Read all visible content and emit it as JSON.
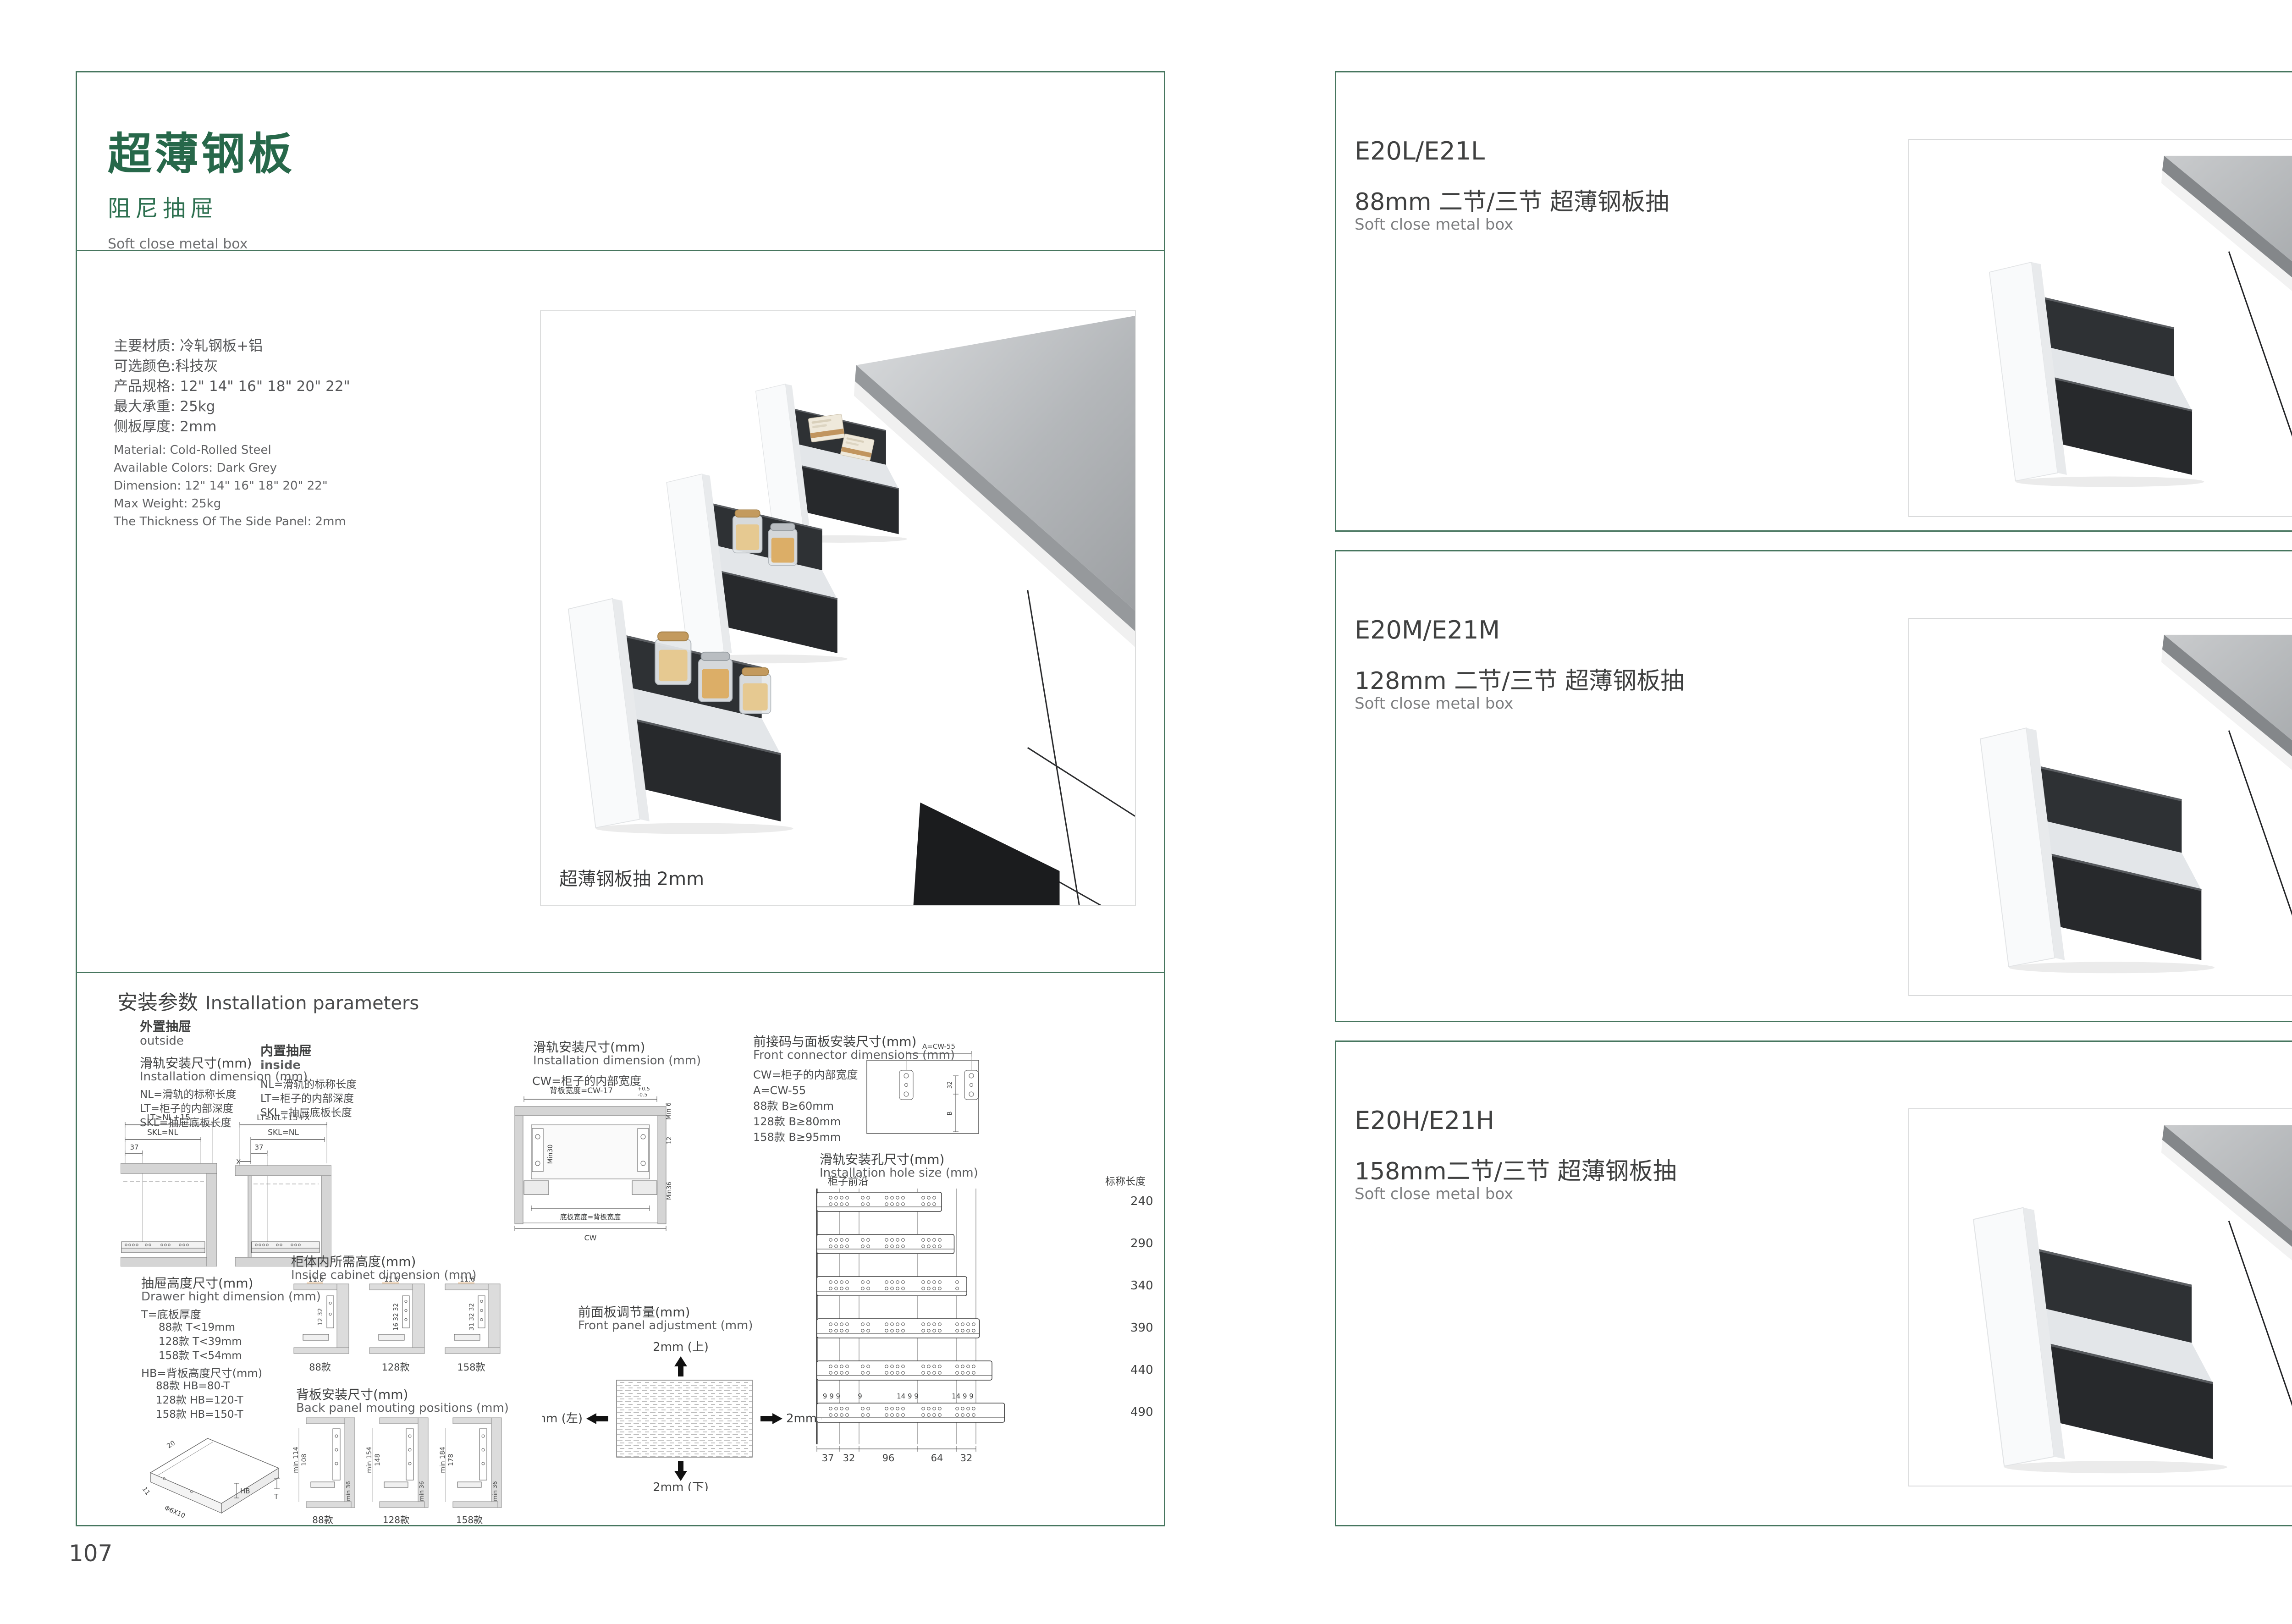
{
  "colors": {
    "brand_green": "#27684a",
    "border_green": "#47765f",
    "dim_orange": "#e0923f",
    "drawer_dark": "#2e3134",
    "counter_gray": "#aaadb0"
  },
  "page_left": {
    "page_number": "107",
    "header": {
      "title": "超薄钢板",
      "subtitle": "阻尼抽屉",
      "subtitle_en": "Soft close metal box"
    },
    "specs_cn": [
      "主要材质: 冷轧钢板+铝",
      "可选颜色:科技灰",
      "产品规格: 12\" 14\" 16\" 18\" 20\" 22\"",
      "最大承重: 25kg",
      "侧板厚度: 2mm"
    ],
    "specs_en": [
      "Material: Cold-Rolled Steel",
      "Available Colors: Dark Grey",
      "Dimension: 12\" 14\" 16\" 18\" 20\" 22\"",
      "Max Weight: 25kg",
      "The Thickness Of The Side Panel: 2mm"
    ],
    "product_caption": "超薄钢板抽 2mm",
    "install": {
      "title_cn": "安装参数",
      "title_en": "Installation parameters",
      "outside": {
        "label_cn": "外置抽屉",
        "label_en": "outside",
        "dim_cn": "滑轨安装尺寸(mm)",
        "dim_en": "Installation dimension (mm)",
        "note1": "NL=滑轨的标称长度",
        "note2": "LT=柜子的内部深度",
        "note3": "SKL=抽屉底板长度",
        "d_top": "LT≥NL+15",
        "d_mid": "SKL=NL",
        "d_small": "37"
      },
      "inside": {
        "label_cn": "内置抽屉",
        "label_en": "inside",
        "note1": "NL=滑轨的标称长度",
        "note2": "LT=柜子的内部深度",
        "note3": "SKL=抽屉底板长度",
        "d_top": "LT≥NL+15+X",
        "d_mid": "SKL=NL",
        "d_small": "37",
        "d_x": "X"
      },
      "width": {
        "title_cn": "滑轨安装尺寸(mm)",
        "title_en": "Installation dimension (mm)",
        "note": "CW=柜子的内部宽度",
        "d_top": "背板宽度=CW-17",
        "d_tol_p": "+0.5",
        "d_tol_m": "-0.5",
        "d_min6": "Min 6",
        "d_min30": "Min30",
        "d_12": "12",
        "d_min36": "Min36",
        "d_bottom": "底板宽度=背板宽度",
        "d_cw": "CW"
      },
      "connector": {
        "title_cn": "前接码与面板安装尺寸(mm)",
        "title_en": "Front connector  dimensions (mm)",
        "note1": "CW=柜子的内部宽度",
        "note2": "A=CW-55",
        "note3": "88款    B≥60mm",
        "note4": "128款  B≥80mm",
        "note5": "158款  B≥95mm",
        "d_a": "A=CW-55",
        "d_32": "32",
        "d_b": "B"
      },
      "holes": {
        "title_cn": "滑轨安装孔尺寸(mm)",
        "title_en": "Installation hole size (mm)",
        "front_edge": "柜子前沿",
        "len_label": "标称长度",
        "lengths": [
          "240",
          "290",
          "340",
          "390",
          "440",
          "490"
        ],
        "top_dims": [
          "9 9 9",
          "9",
          "14 9 9",
          "14 9 9"
        ],
        "bottom_dims": [
          "37",
          "32",
          "96",
          "64",
          "32"
        ]
      },
      "height": {
        "title_cn": "抽屉高度尺寸(mm)",
        "title_en": "Drawer hight dimension (mm)",
        "t_label": "T=底板厚度",
        "t1": "88款   T<19mm",
        "t2": "128款  T<39mm",
        "t3": "158款  T<54mm",
        "hb_label": "HB=背板高度尺寸(mm)",
        "hb1": "88款   HB=80-T",
        "hb2": "128款 HB=120-T",
        "hb3": "158款 HB=150-T",
        "iso": {
          "d20": "20",
          "d11": "11",
          "screw": "Φ6X10",
          "hb": "HB",
          "t": "T"
        }
      },
      "cabinet": {
        "title_cn": "柜体内所需高度(mm)",
        "title_en": "Inside cabinet dimension (mm)",
        "variants": [
          {
            "name": "88款",
            "top": "11.6",
            "side": "12 32"
          },
          {
            "name": "128款",
            "top": "11.6",
            "side": "16 32 32"
          },
          {
            "name": "158款",
            "top": "11.6",
            "side": "31 32 32"
          }
        ]
      },
      "back": {
        "title_cn": "背板安装尺寸(mm)",
        "title_en": "Back panel mouting positions (mm)",
        "variants": [
          {
            "name": "88款",
            "o": "min 114",
            "i": "108",
            "b": "min 36"
          },
          {
            "name": "128款",
            "o": "min 154",
            "i": "148",
            "b": "min 36"
          },
          {
            "name": "158款",
            "o": "min 184",
            "i": "178",
            "b": "min 36"
          }
        ]
      },
      "adjust": {
        "title_cn": "前面板调节量(mm)",
        "title_en": "Front panel adjustment (mm)",
        "up": "2mm (上)",
        "down": "2mm (下)",
        "left": "2mm (左)",
        "right": "2mm (右)"
      }
    }
  },
  "page_right": {
    "page_number": "108",
    "products": [
      {
        "code": "E20L/E21L",
        "title": "88mm 二节/三节 超薄钢板抽",
        "subtitle": "Soft close metal box"
      },
      {
        "code": "E20M/E21M",
        "title": "128mm 二节/三节 超薄钢板抽",
        "subtitle": "Soft close metal box"
      },
      {
        "code": "E20H/E21H",
        "title": "158mm二节/三节 超薄钢板抽",
        "subtitle": "Soft close metal box"
      }
    ]
  }
}
